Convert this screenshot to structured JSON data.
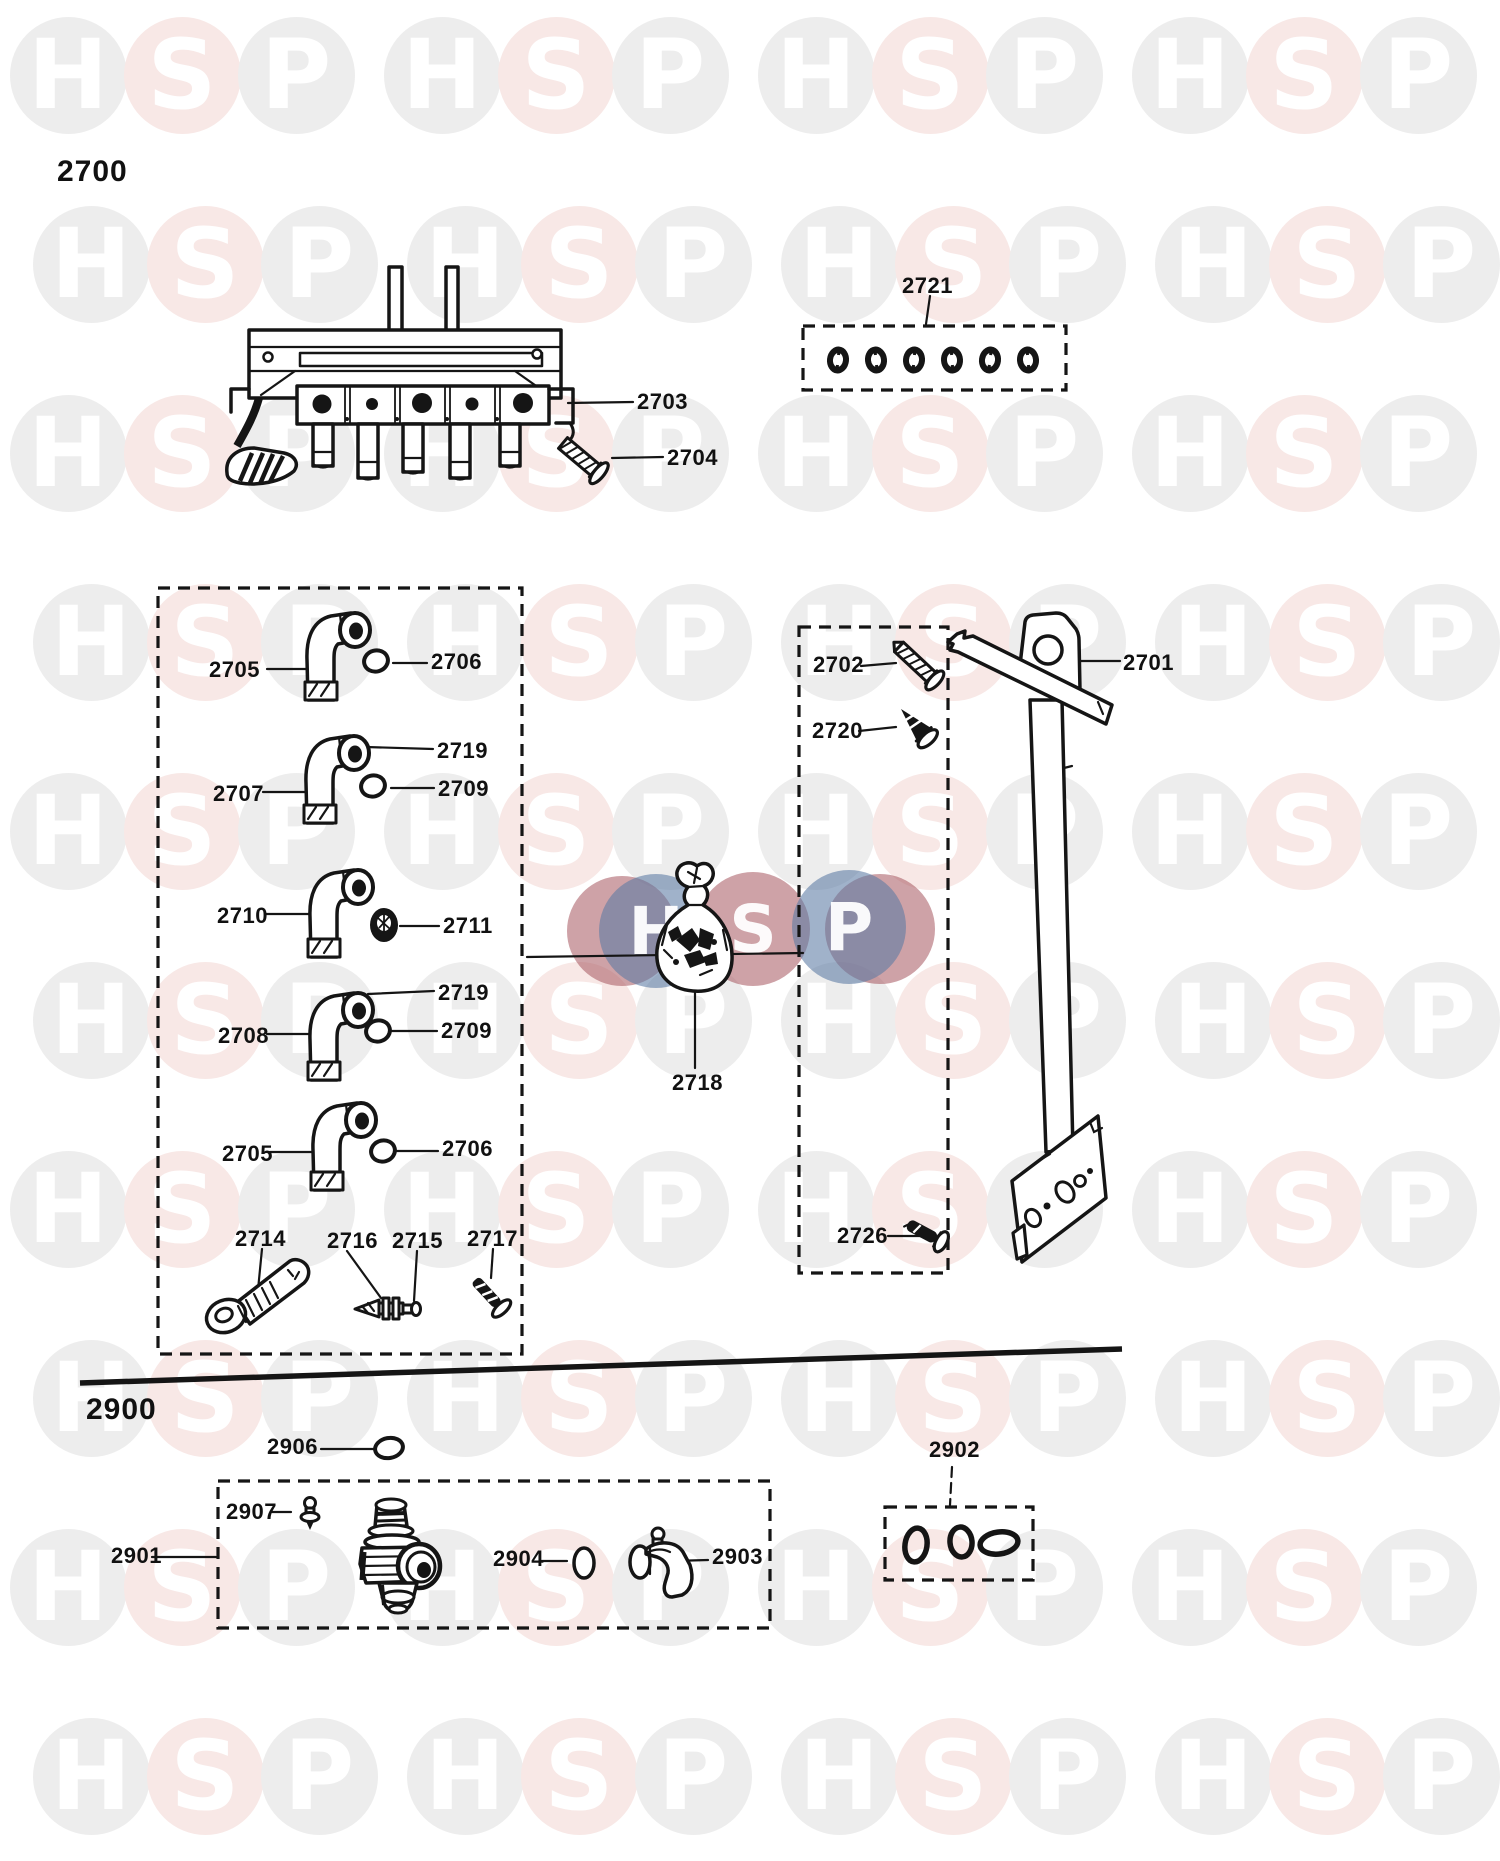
{
  "sections": {
    "top": "2700",
    "bottom": "2900"
  },
  "labels": {
    "l2703": "2703",
    "l2704": "2704",
    "l2721": "2721",
    "l2705a": "2705",
    "l2706a": "2706",
    "l2719a": "2719",
    "l2707": "2707",
    "l2709a": "2709",
    "l2710": "2710",
    "l2711": "2711",
    "l2719b": "2719",
    "l2708": "2708",
    "l2709b": "2709",
    "l2705b": "2705",
    "l2706b": "2706",
    "l2714": "2714",
    "l2716": "2716",
    "l2715": "2715",
    "l2717": "2717",
    "l2702": "2702",
    "l2720": "2720",
    "l2701": "2701",
    "l2726": "2726",
    "l2718": "2718",
    "l2906": "2906",
    "l2902": "2902",
    "l2907": "2907",
    "l2901": "2901",
    "l2904": "2904",
    "l2903": "2903"
  },
  "watermark": {
    "letters": [
      "H",
      "S",
      "P"
    ],
    "circle_gray": "#ededed",
    "circle_pink": "#f8e8e6",
    "letter_color": "#ffffff"
  },
  "logo": {
    "letters": [
      "H",
      "S",
      "P"
    ],
    "blue": "#5c7aa3",
    "red": "#a6555e"
  }
}
